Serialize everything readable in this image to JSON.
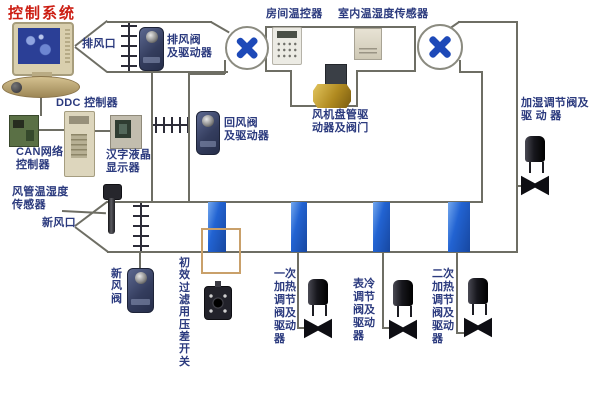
{
  "title": "控制系统",
  "colors": {
    "title": "#cc1d12",
    "label": "#2b3a7e",
    "line": "#6e6e64",
    "fan_blade": "#1d49b8",
    "coil_blue": "#2263d2",
    "filter_frame": "#c9a06a"
  },
  "labels": {
    "exhaust_outlet": "排风口",
    "exhaust_damper_actuator": "排风阀\n及驱动器",
    "room_thermostat": "房间温控器",
    "indoor_temp_humidity_sensor": "室内温湿度传感器",
    "humidifier_valve": "加湿调节阀及\n驱 动 器",
    "ddc_controller": "DDC 控制器",
    "can_network_controller": "CAN网络\n控制器",
    "chinese_lcd_display": "汉字液晶\n显示器",
    "return_air_damper": "回风阀\n及驱动器",
    "fan_coil_valve": "风机盘管驱\n动器及阀门",
    "duct_temp_humidity_sensor": "风管温湿度\n传感器",
    "fresh_air_inlet": "新风口",
    "fresh_air_damper": "新风阀",
    "filter_pressure_switch": "初效过滤用压差开关",
    "primary_heating_valve": "一次加热调节阀及驱动器",
    "cooling_coil_valve": "表冷调节阀及驱动器",
    "secondary_heating_valve": "二次加热调节阀及驱动器"
  }
}
